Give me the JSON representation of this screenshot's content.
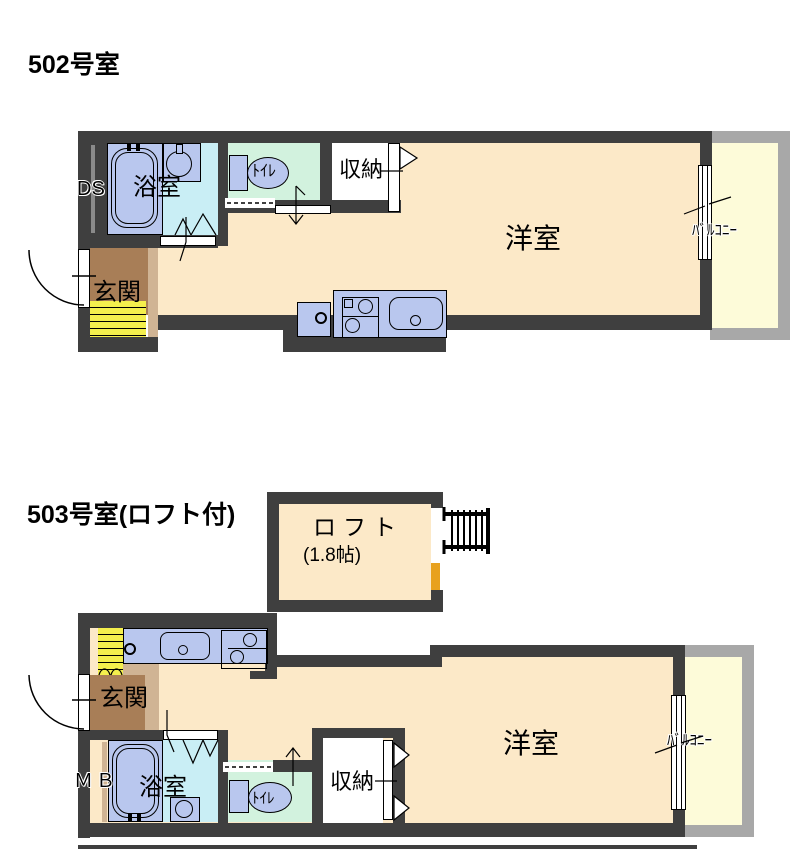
{
  "page": {
    "background": "#ffffff"
  },
  "colors": {
    "wall": "#3f3f3f",
    "room_floor": "#fce9c8",
    "bathroom_floor": "#c9eef5",
    "toilet_floor": "#d2f2de",
    "fixture_blue": "#b9c7ee",
    "balcony_floor": "#fdfbd9",
    "balcony_wall": "#a8a8a8",
    "entrance_floor": "#a87e57",
    "entrance_step": "#d0b494",
    "stairs_yellow": "#f4ef4d",
    "loft_bar_orange": "#e8a11d",
    "duct_stripe_gray": "#8a8a8a"
  },
  "plan_502": {
    "title": "502号室",
    "labels": {
      "duct_space": "DS",
      "bathroom": "浴室",
      "toilet": "ﾄｲﾚ",
      "storage": "収納",
      "western_room": "洋室",
      "entrance": "玄関",
      "balcony": "ﾊﾞﾙｺﾆｰ"
    }
  },
  "plan_503": {
    "title": "503号室(ロフト付)",
    "labels": {
      "loft": "ロフト",
      "loft_area": "(1.8帖)",
      "meter_box": "ＭＢ",
      "bathroom": "浴室",
      "toilet": "ﾄｲﾚ",
      "storage": "収納",
      "western_room": "洋室",
      "entrance": "玄関",
      "balcony": "ﾊﾞﾙｺﾆｰ"
    }
  }
}
